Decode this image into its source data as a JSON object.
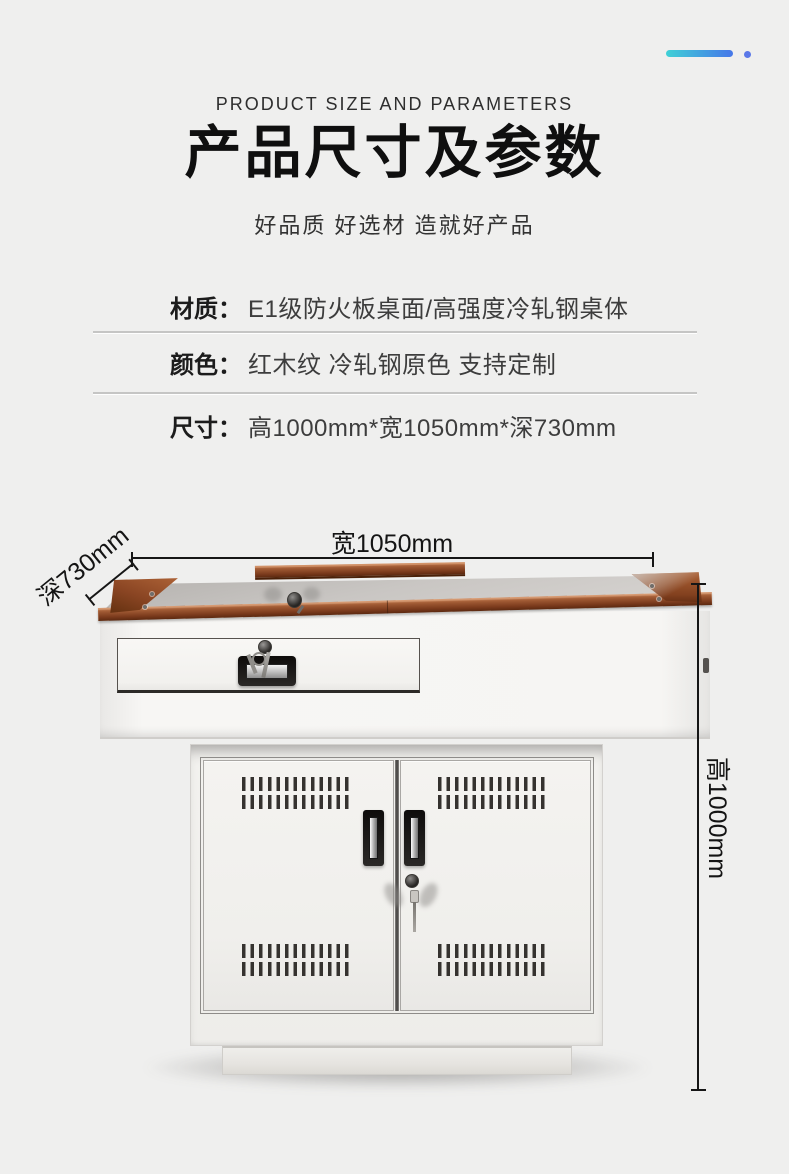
{
  "header": {
    "eyebrow": "PRODUCT SIZE AND PARAMETERS",
    "title": "产品尺寸及参数",
    "subtitle": "好品质 好选材 造就好产品"
  },
  "specs": [
    {
      "label": "材质：",
      "value": "E1级防火板桌面/高强度冷轧钢桌体"
    },
    {
      "label": "颜色：",
      "value": "红木纹 冷轧钢原色 支持定制"
    },
    {
      "label": "尺寸：",
      "value": "高1000mm*宽1050mm*深730mm"
    }
  ],
  "dimensions": {
    "width": "宽1050mm",
    "depth": "深730mm",
    "height": "高1000mm"
  },
  "colors": {
    "accent_teal": "#3fd0d6",
    "accent_blue": "#4677e9",
    "accent_dot": "#5b78e8",
    "background": "#efefee",
    "text_dark": "#141414",
    "wood": "#8a4a28",
    "steel_white": "#f5f4f2"
  }
}
